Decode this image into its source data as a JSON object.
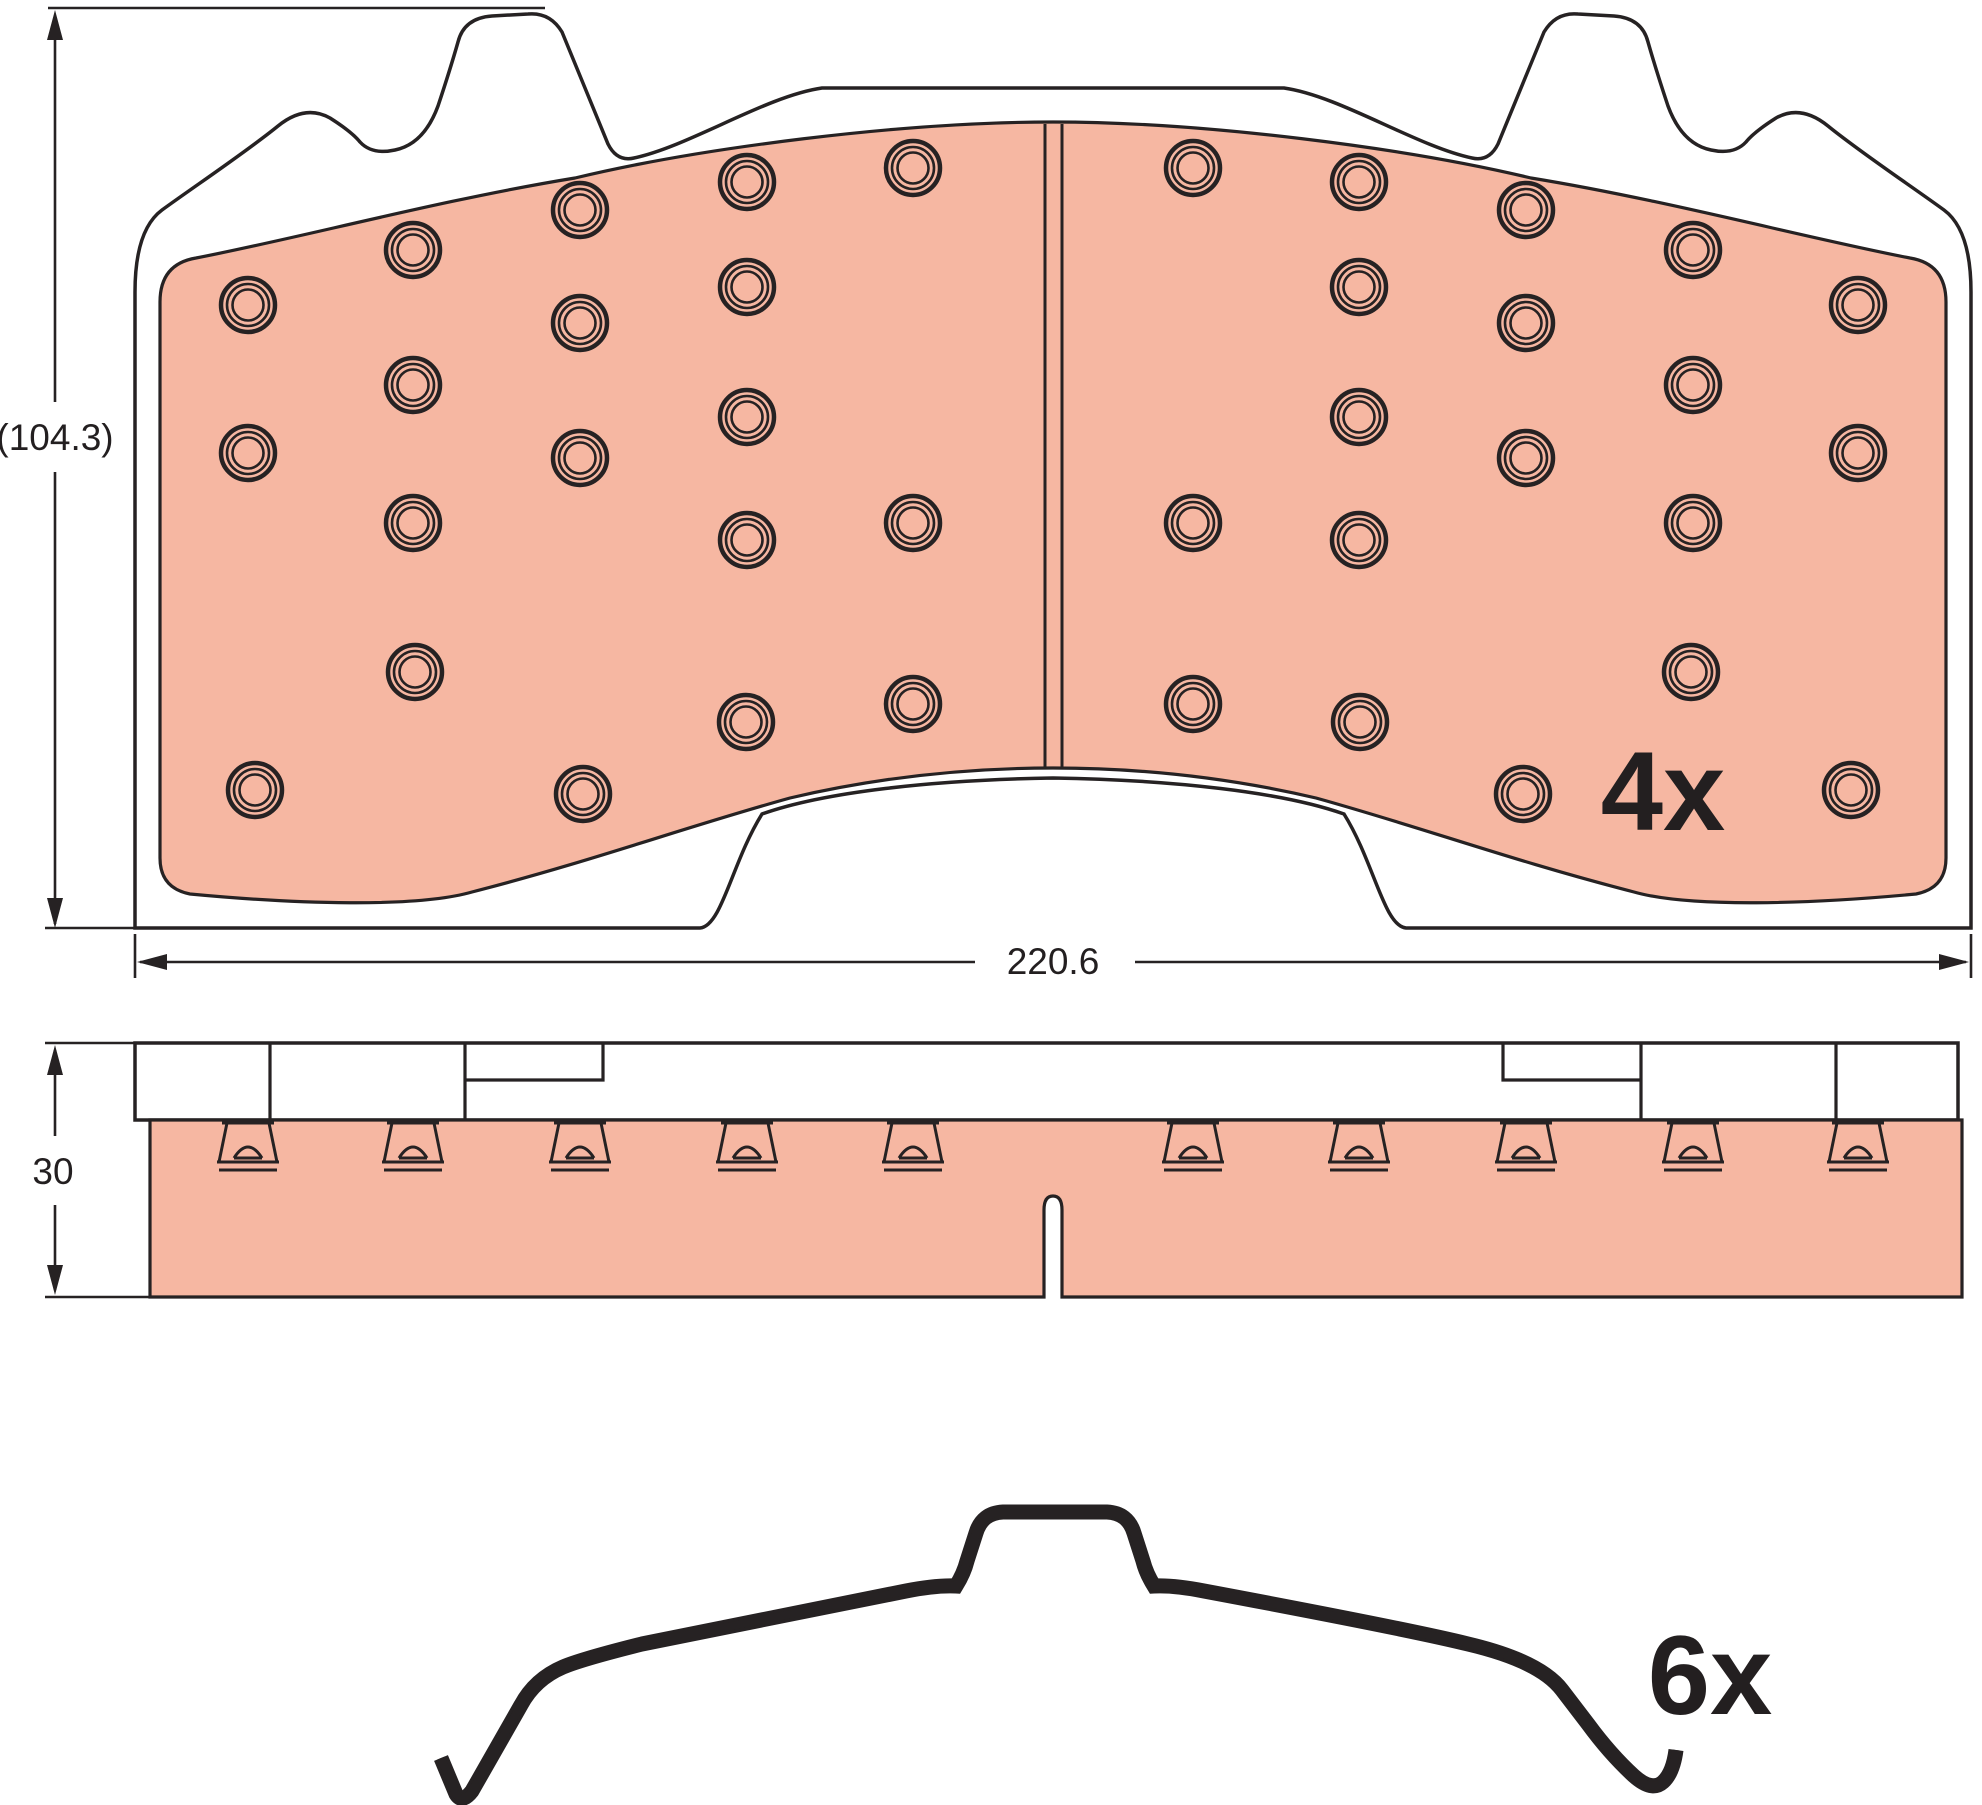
{
  "drawing_title": "brake-pad-set-technical-drawing",
  "colors": {
    "friction": "#F6B7A2",
    "outline": "#262223",
    "plate": "#FFFFFF",
    "background": "#FFFFFF",
    "text": "#231F20"
  },
  "front_view": {
    "quantity_label": "4x",
    "dim_height_label": "(104.3)",
    "dim_width_label": "220.6",
    "holes": [
      {
        "x": 248,
        "y": 305
      },
      {
        "x": 248,
        "y": 453
      },
      {
        "x": 255,
        "y": 790
      },
      {
        "x": 413,
        "y": 250
      },
      {
        "x": 413,
        "y": 385
      },
      {
        "x": 413,
        "y": 523
      },
      {
        "x": 415,
        "y": 672
      },
      {
        "x": 580,
        "y": 210
      },
      {
        "x": 580,
        "y": 323
      },
      {
        "x": 580,
        "y": 458
      },
      {
        "x": 583,
        "y": 794
      },
      {
        "x": 747,
        "y": 182
      },
      {
        "x": 747,
        "y": 287
      },
      {
        "x": 747,
        "y": 417
      },
      {
        "x": 747,
        "y": 540
      },
      {
        "x": 746,
        "y": 722
      },
      {
        "x": 913,
        "y": 168
      },
      {
        "x": 913,
        "y": 523
      },
      {
        "x": 913,
        "y": 704
      },
      {
        "x": 1858,
        "y": 305
      },
      {
        "x": 1858,
        "y": 453
      },
      {
        "x": 1851,
        "y": 790
      },
      {
        "x": 1693,
        "y": 250
      },
      {
        "x": 1693,
        "y": 385
      },
      {
        "x": 1693,
        "y": 523
      },
      {
        "x": 1691,
        "y": 672
      },
      {
        "x": 1526,
        "y": 210
      },
      {
        "x": 1526,
        "y": 323
      },
      {
        "x": 1526,
        "y": 458
      },
      {
        "x": 1523,
        "y": 794
      },
      {
        "x": 1359,
        "y": 182
      },
      {
        "x": 1359,
        "y": 287
      },
      {
        "x": 1359,
        "y": 417
      },
      {
        "x": 1359,
        "y": 540
      },
      {
        "x": 1360,
        "y": 722
      },
      {
        "x": 1193,
        "y": 168
      },
      {
        "x": 1193,
        "y": 523
      },
      {
        "x": 1193,
        "y": 704
      }
    ],
    "hole_ring_radii": [
      27,
      21,
      15.5
    ]
  },
  "side_view": {
    "dim_thickness_label": "30",
    "rivet_columns": [
      248,
      413,
      580,
      747,
      913,
      1193,
      1359,
      1526,
      1693,
      1858
    ]
  },
  "accessory_clip": {
    "quantity_label": "6x"
  }
}
